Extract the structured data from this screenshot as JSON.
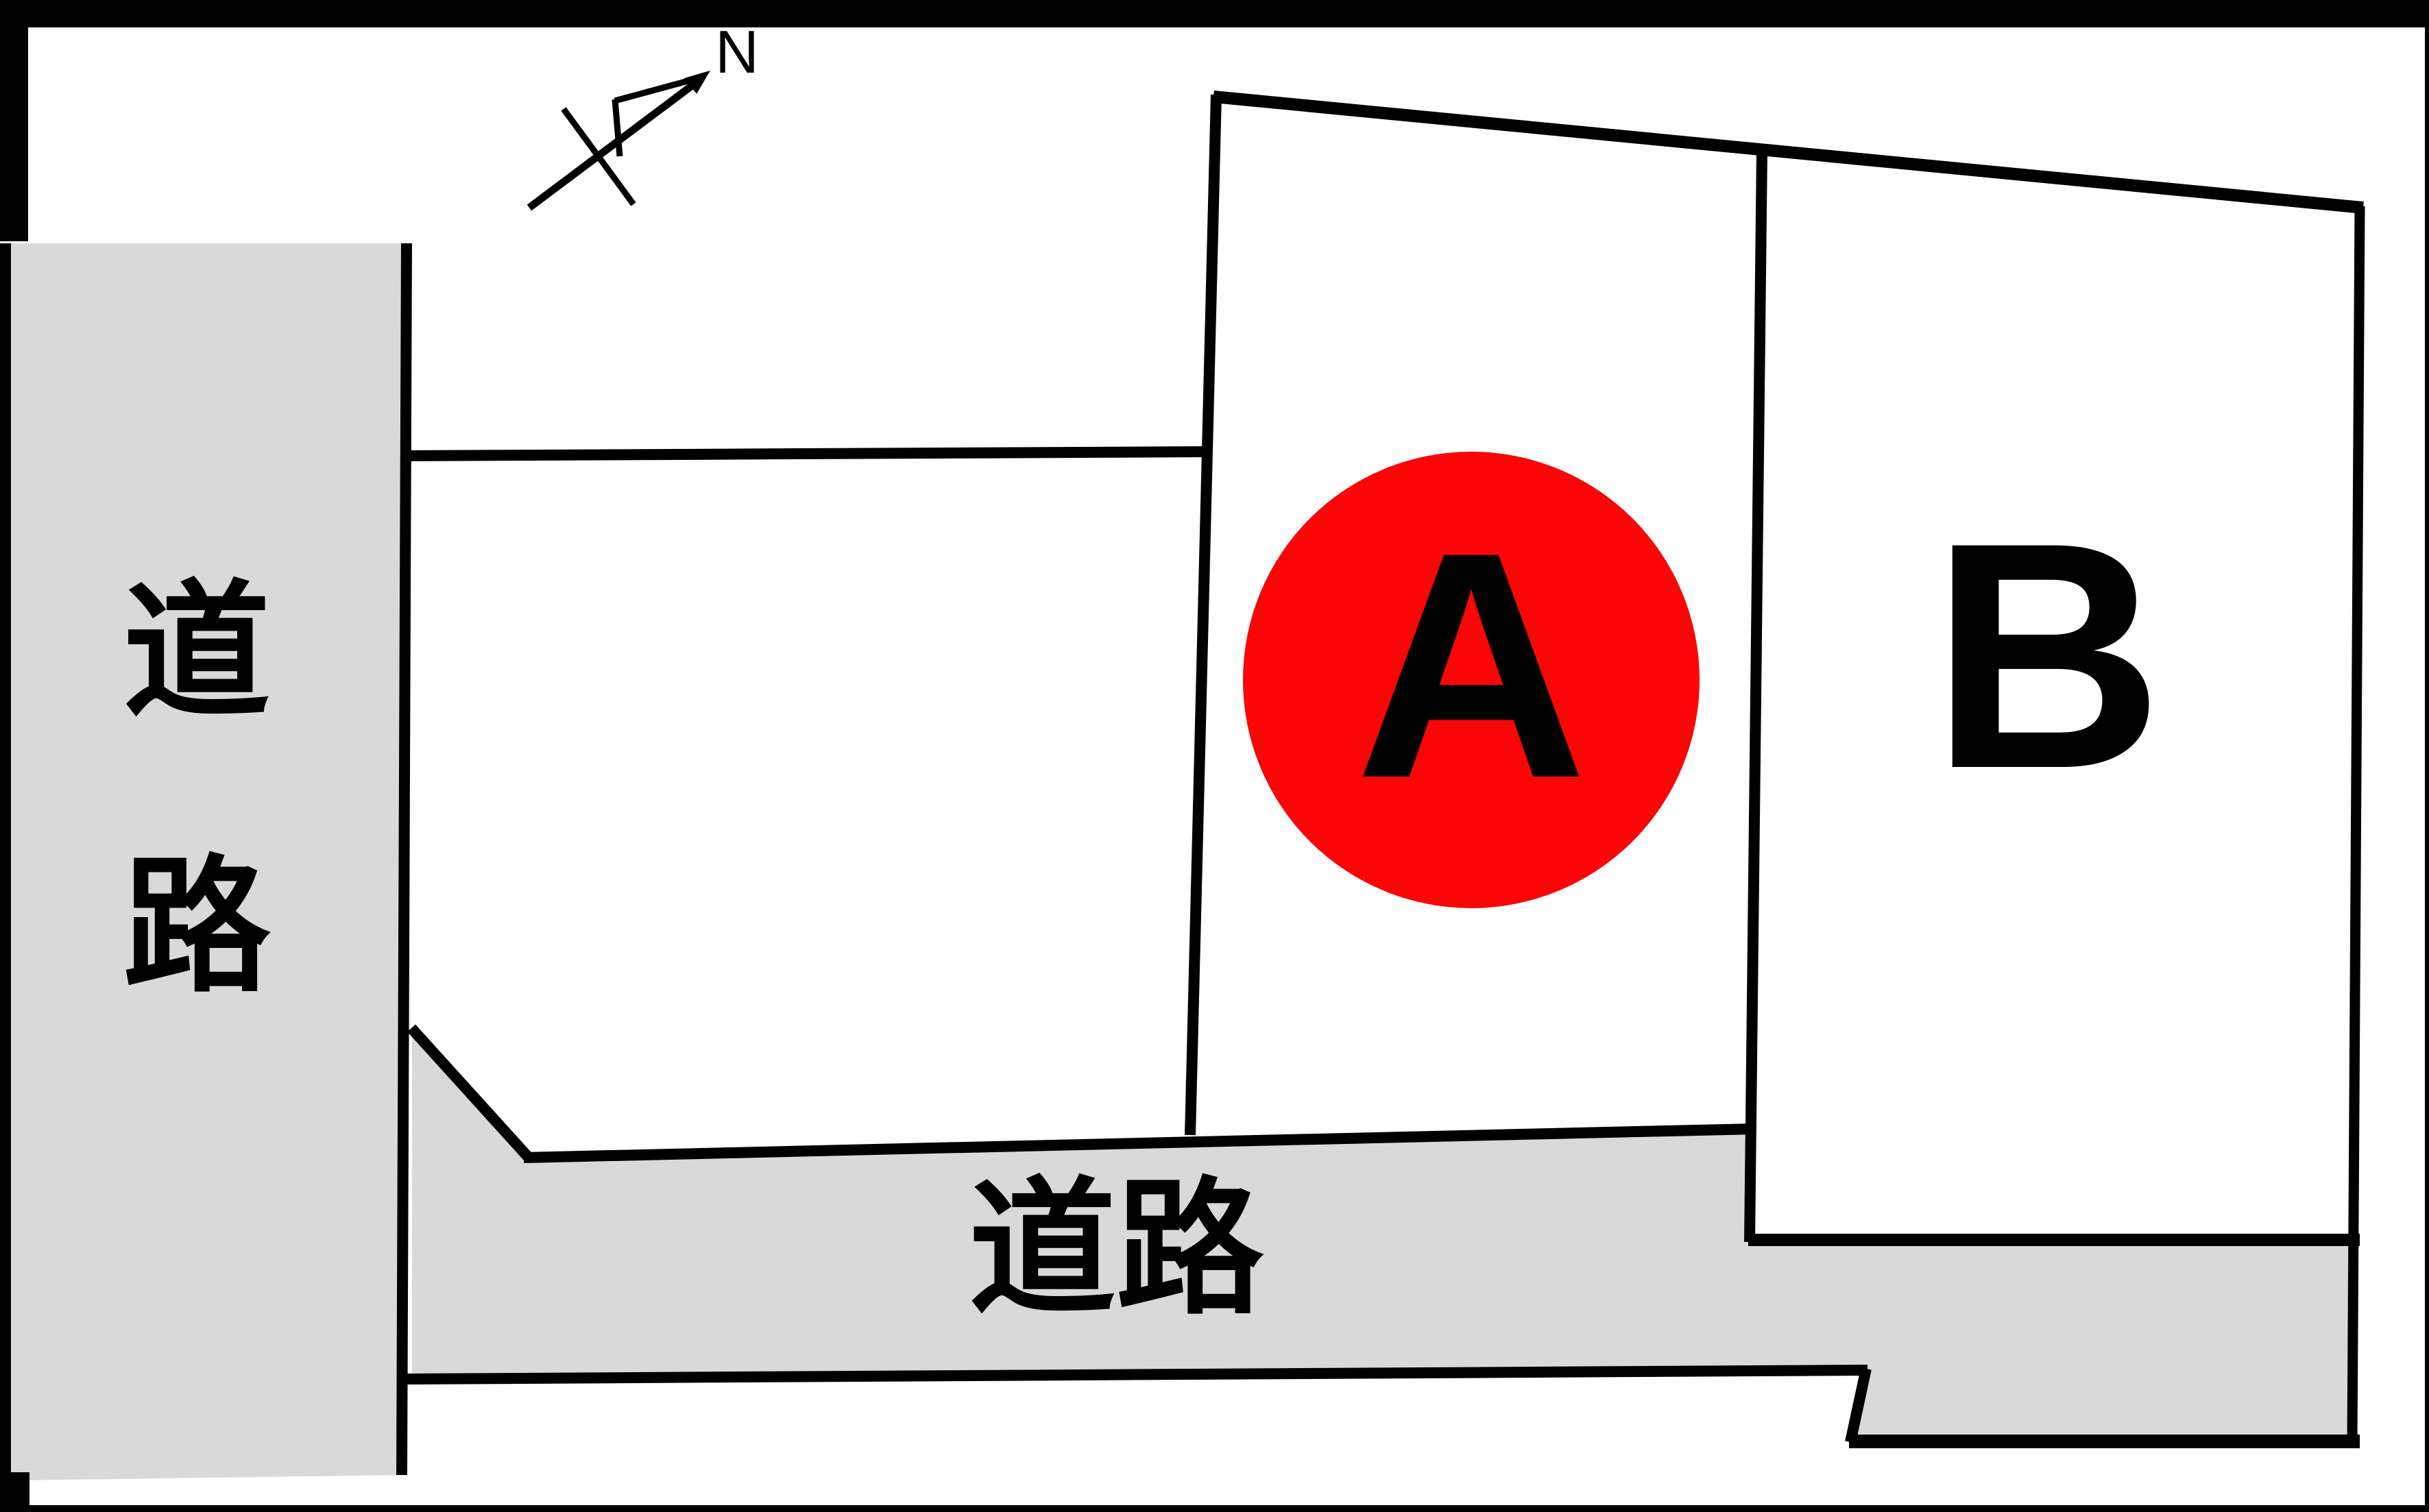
{
  "diagram": {
    "type": "land-plot-map",
    "compass": {
      "north_label": "N"
    },
    "plots": {
      "a": {
        "label": "A",
        "marker_shape": "circle",
        "marker_color": "#fa0606"
      },
      "b": {
        "label": "B"
      }
    },
    "roads": {
      "left_vertical": {
        "label": "道路",
        "chars": [
          "道",
          "路"
        ]
      },
      "bottom_horizontal": {
        "label": "道路"
      }
    },
    "colors": {
      "background": "#ffffff",
      "line": "#000000",
      "road_fill": "#d9d9d9",
      "plot_a_marker": "#fa0606"
    }
  }
}
